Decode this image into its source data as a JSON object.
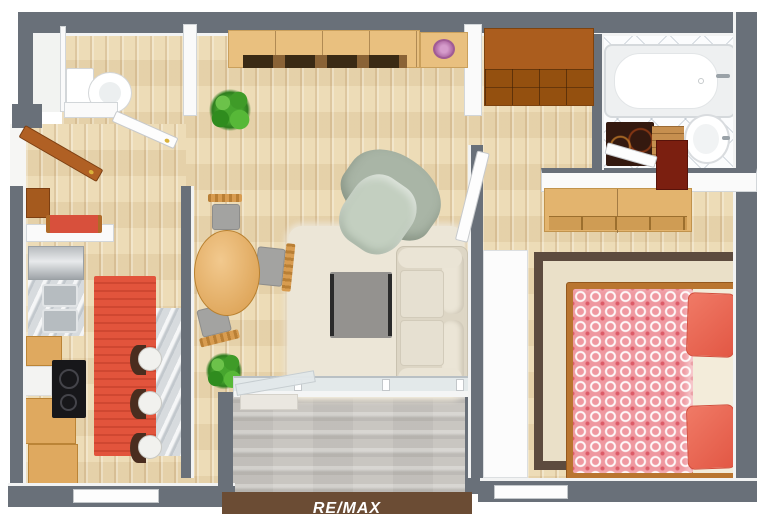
{
  "scene": {
    "kind": "3d-floor-plan-top-view",
    "layout": "one-bedroom-apartment"
  },
  "watermark": {
    "text": "RE/MAX",
    "text_color": "#ffffff",
    "band_color": "#6b4c34"
  },
  "palette": {
    "exterior_wall": "#697079",
    "interior_wall": "#fafafa",
    "wood_floor": "#ecd9b2",
    "bathroom_tile": "#fbfcfd",
    "balcony_concrete": "#c9c6c1",
    "marble_counter": "#d7dbde",
    "kitchen_rug_red": "#e2543c",
    "living_rug_cream": "#ece6d7",
    "bedroom_rug_border": "#5d4b3e",
    "sofa_cream": "#ddd6c5",
    "armchair_sage": "#a9b5a6",
    "coffee_table_gray": "#94928f",
    "light_wood_furniture": "#e9c07f",
    "dark_wood_cabinet": "#ab5d1e",
    "bed_frame_wood": "#b9752f",
    "duvet_pink": "#ef98a0",
    "pillow_coral": "#ee6a57",
    "balcony_rail_brown": "#6b4c34"
  },
  "rooms": {
    "wc": {
      "name": "wc",
      "items": [
        "toilet",
        "wc-door"
      ]
    },
    "entry_hall": {
      "name": "entry-hall",
      "items": [
        "entry-door",
        "shoe-cabinet",
        "red-bench"
      ]
    },
    "kitchen": {
      "name": "kitchen",
      "stool_count": 3,
      "items": [
        "fridge",
        "double-sink",
        "marble-counter",
        "cooktop",
        "wood-cabinets",
        "red-runner-rug",
        "bar-counter",
        "bar-stools",
        "window"
      ]
    },
    "living_room": {
      "name": "living-room",
      "dining_chair_count": 3,
      "items": [
        "sideboard",
        "decor-bowl",
        "potted-plant-top",
        "potted-plant-bottom",
        "dining-table",
        "dining-chairs",
        "armchair",
        "sofa",
        "coffee-table",
        "cream-rug"
      ]
    },
    "hallway": {
      "name": "hallway",
      "items": [
        "wardrobe-cabinet",
        "bedroom-door"
      ]
    },
    "bathroom": {
      "name": "bathroom",
      "items": [
        "bathtub",
        "pedestal-sink",
        "dark-bath-mat",
        "wood-bath-mat",
        "red-cabinet",
        "bathroom-door"
      ]
    },
    "bedroom": {
      "name": "bedroom",
      "pillow_count": 2,
      "items": [
        "double-bed",
        "patterned-duvet",
        "coral-pillows",
        "dresser",
        "bordered-rug",
        "white-wardrobe",
        "window"
      ]
    },
    "balcony": {
      "name": "balcony",
      "items": [
        "glass-door-open",
        "window-band",
        "railing"
      ]
    }
  }
}
